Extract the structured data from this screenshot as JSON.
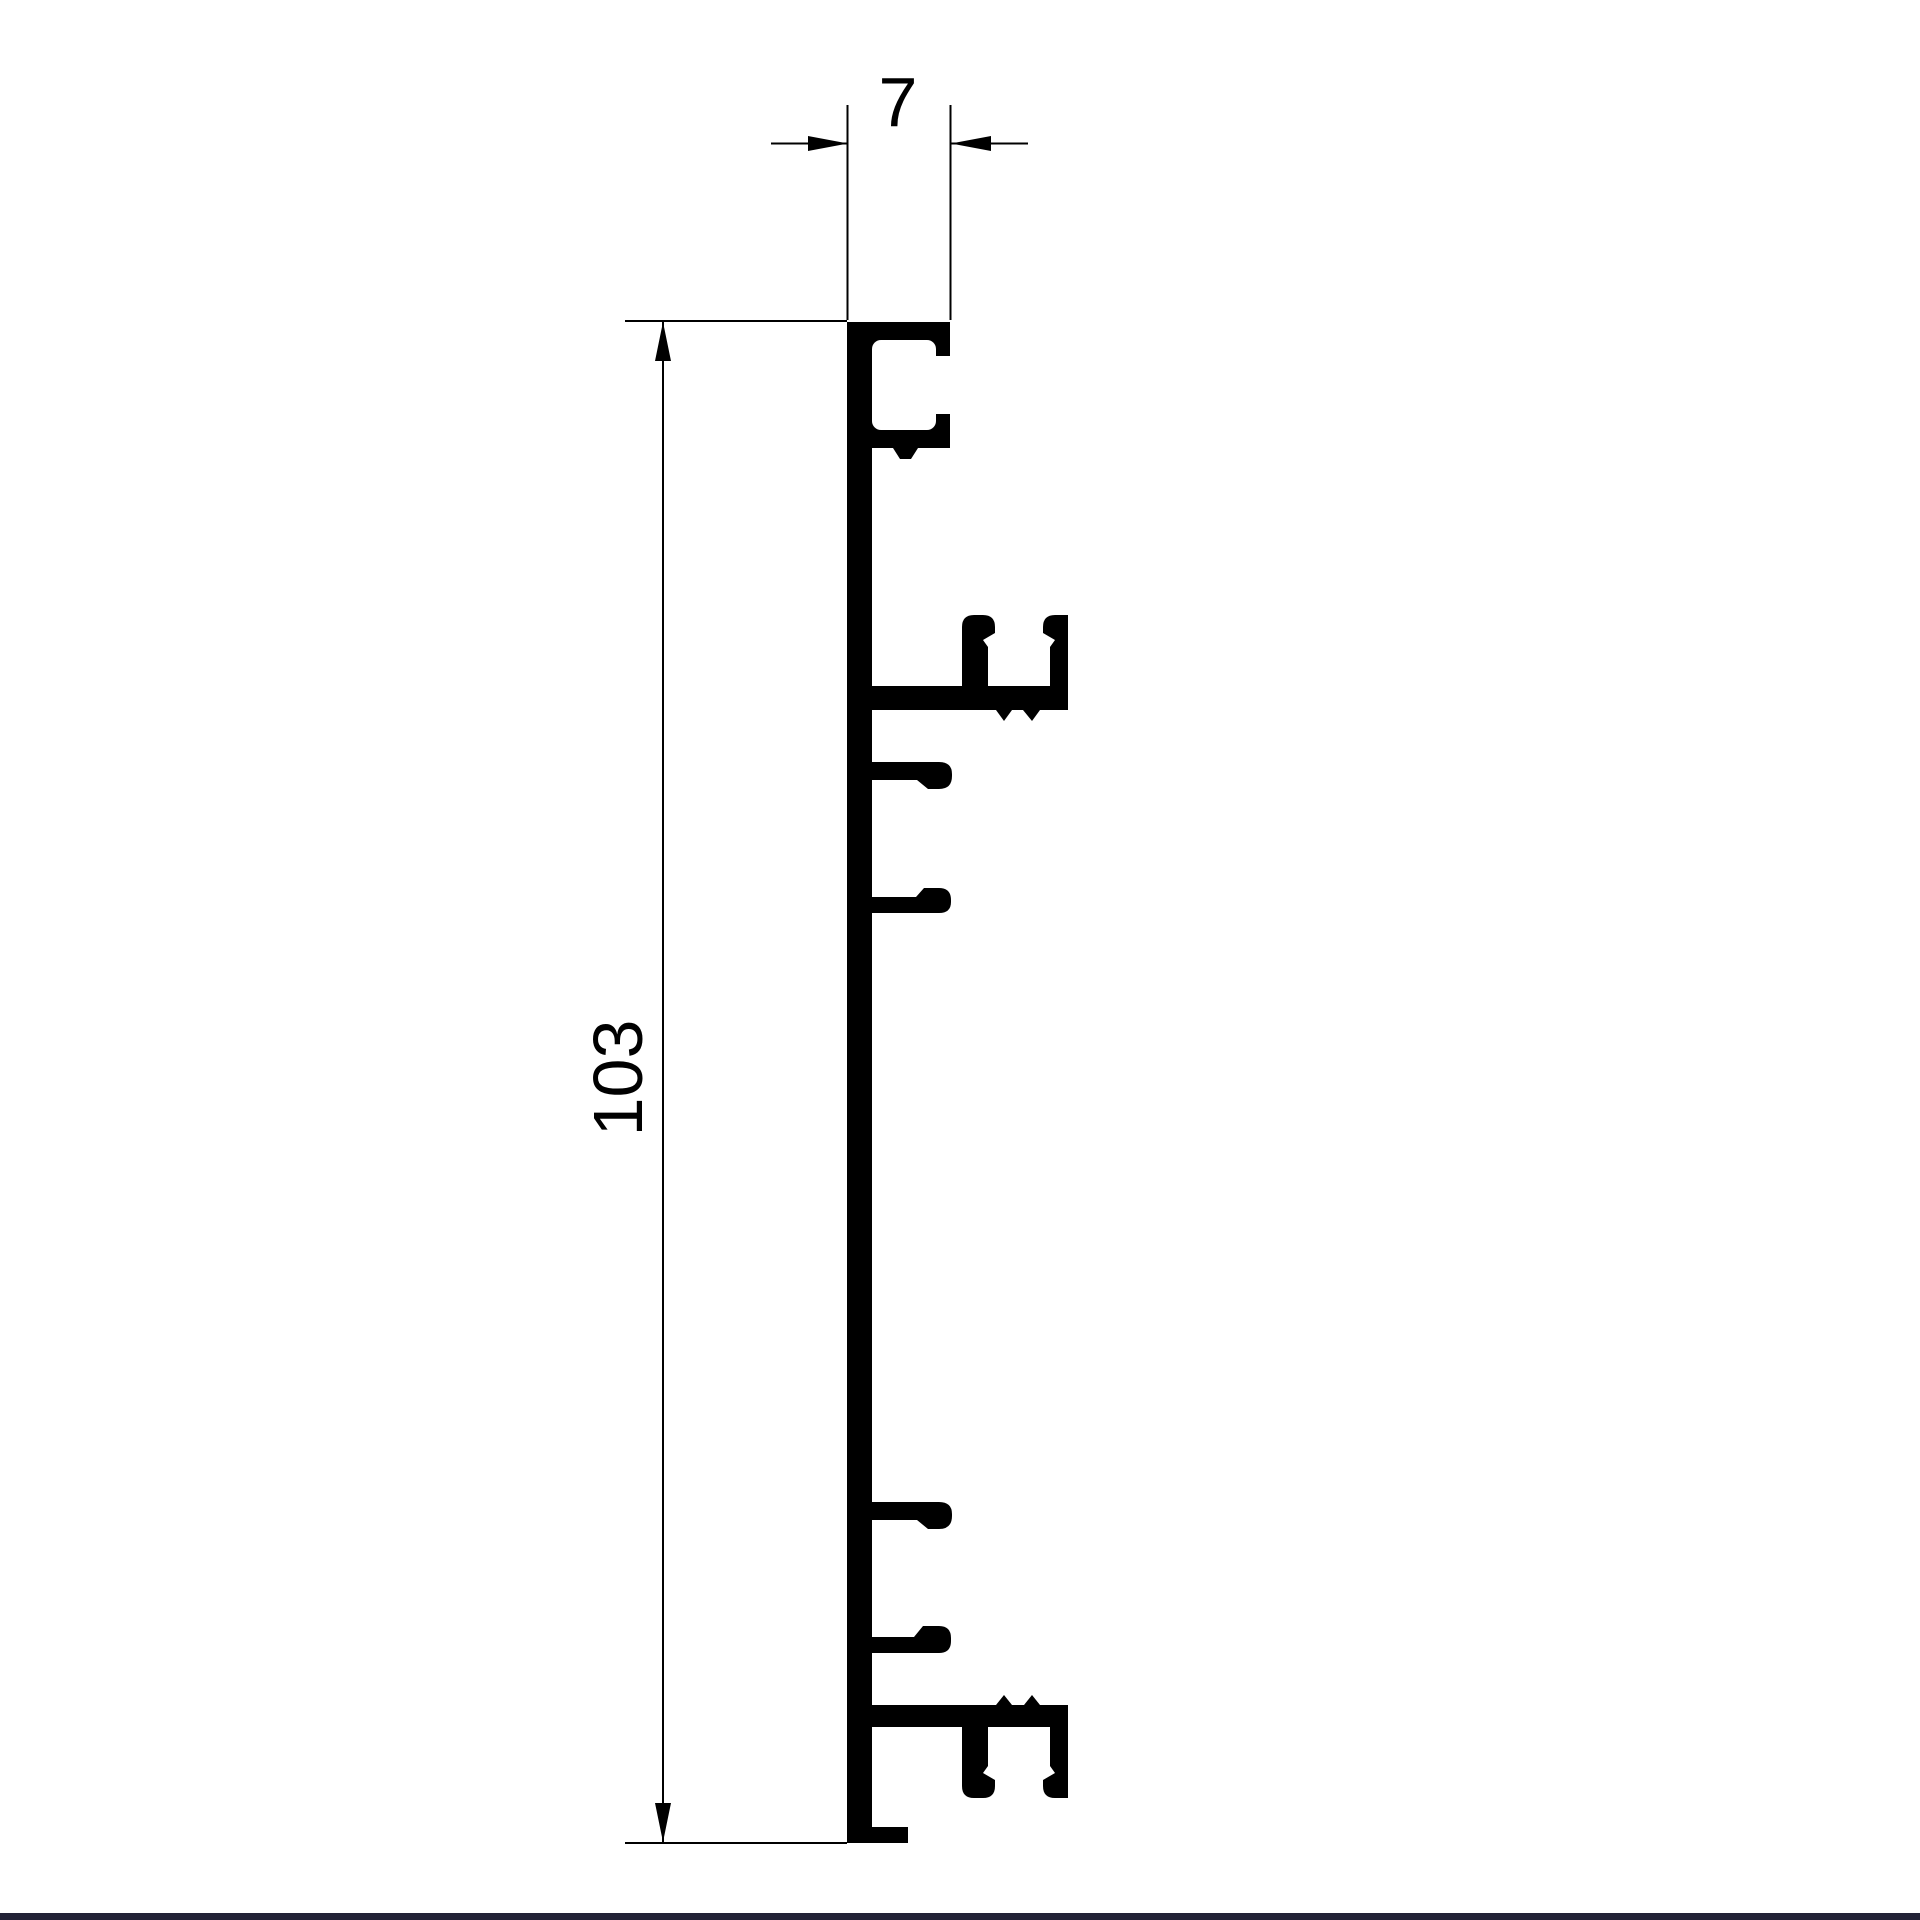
{
  "drawing": {
    "dimensions": {
      "width": {
        "label": "7",
        "unit_hint": ""
      },
      "height": {
        "label": "103",
        "unit_hint": ""
      }
    },
    "colors": {
      "ink": "#000000",
      "background": "#ffffff",
      "bottom_border": "#222236"
    }
  }
}
